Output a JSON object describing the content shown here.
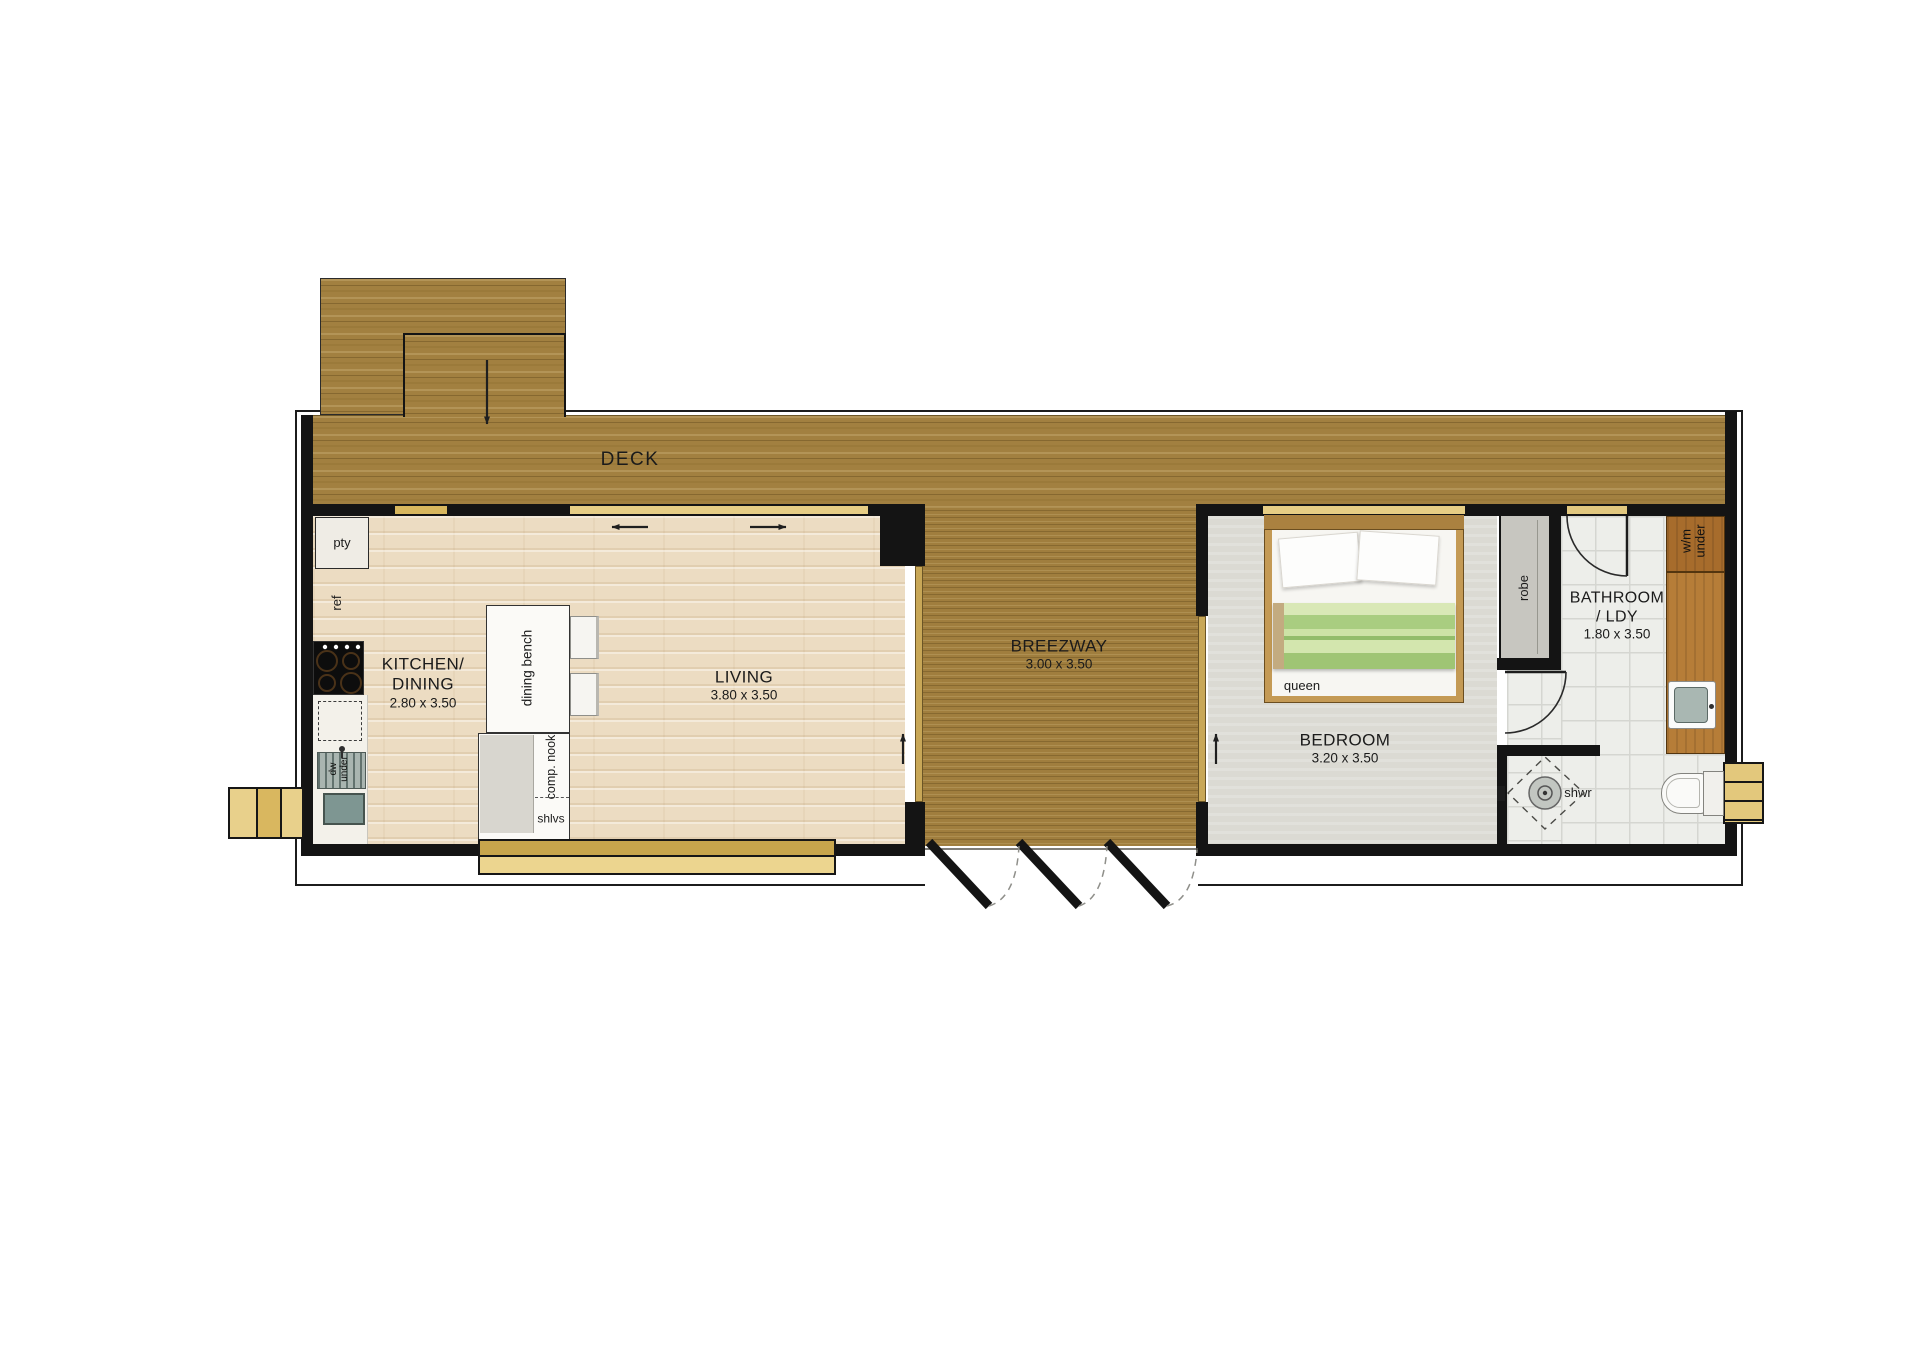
{
  "deck": {
    "label": "DECK"
  },
  "rooms": {
    "kitchen_dining": {
      "line1": "KITCHEN/",
      "line2": "DINING",
      "dims": "2.80 x 3.50"
    },
    "living": {
      "name": "LIVING",
      "dims": "3.80 x 3.50"
    },
    "breezway": {
      "name": "BREEZWAY",
      "dims": "3.00 x 3.50"
    },
    "bedroom": {
      "name": "BEDROOM",
      "dims": "3.20 x 3.50"
    },
    "bathroom_laundry": {
      "line1": "BATHROOM",
      "line2": "/ LDY",
      "dims": "1.80 x 3.50"
    }
  },
  "fixtures": {
    "pantry": "pty",
    "fridge": "ref",
    "dishwasher": "dw\nunder",
    "dining_bench": "dining bench",
    "computer_nook": "comp. nook",
    "shelves": "shlvs",
    "bed_size": "queen",
    "wardrobe": "robe",
    "washing_machine": "w/m\nunder",
    "shower": "shwr"
  },
  "colors": {
    "deck_wood": "#a28040",
    "interior_wood": "#ecdcc2",
    "bedroom_floor": "#dbdad3",
    "tile": "#edeeea",
    "wall": "#141414",
    "window_frame": "#e2c87f",
    "bench_wood": "#b5793a",
    "blanket_green": "#abd083"
  }
}
